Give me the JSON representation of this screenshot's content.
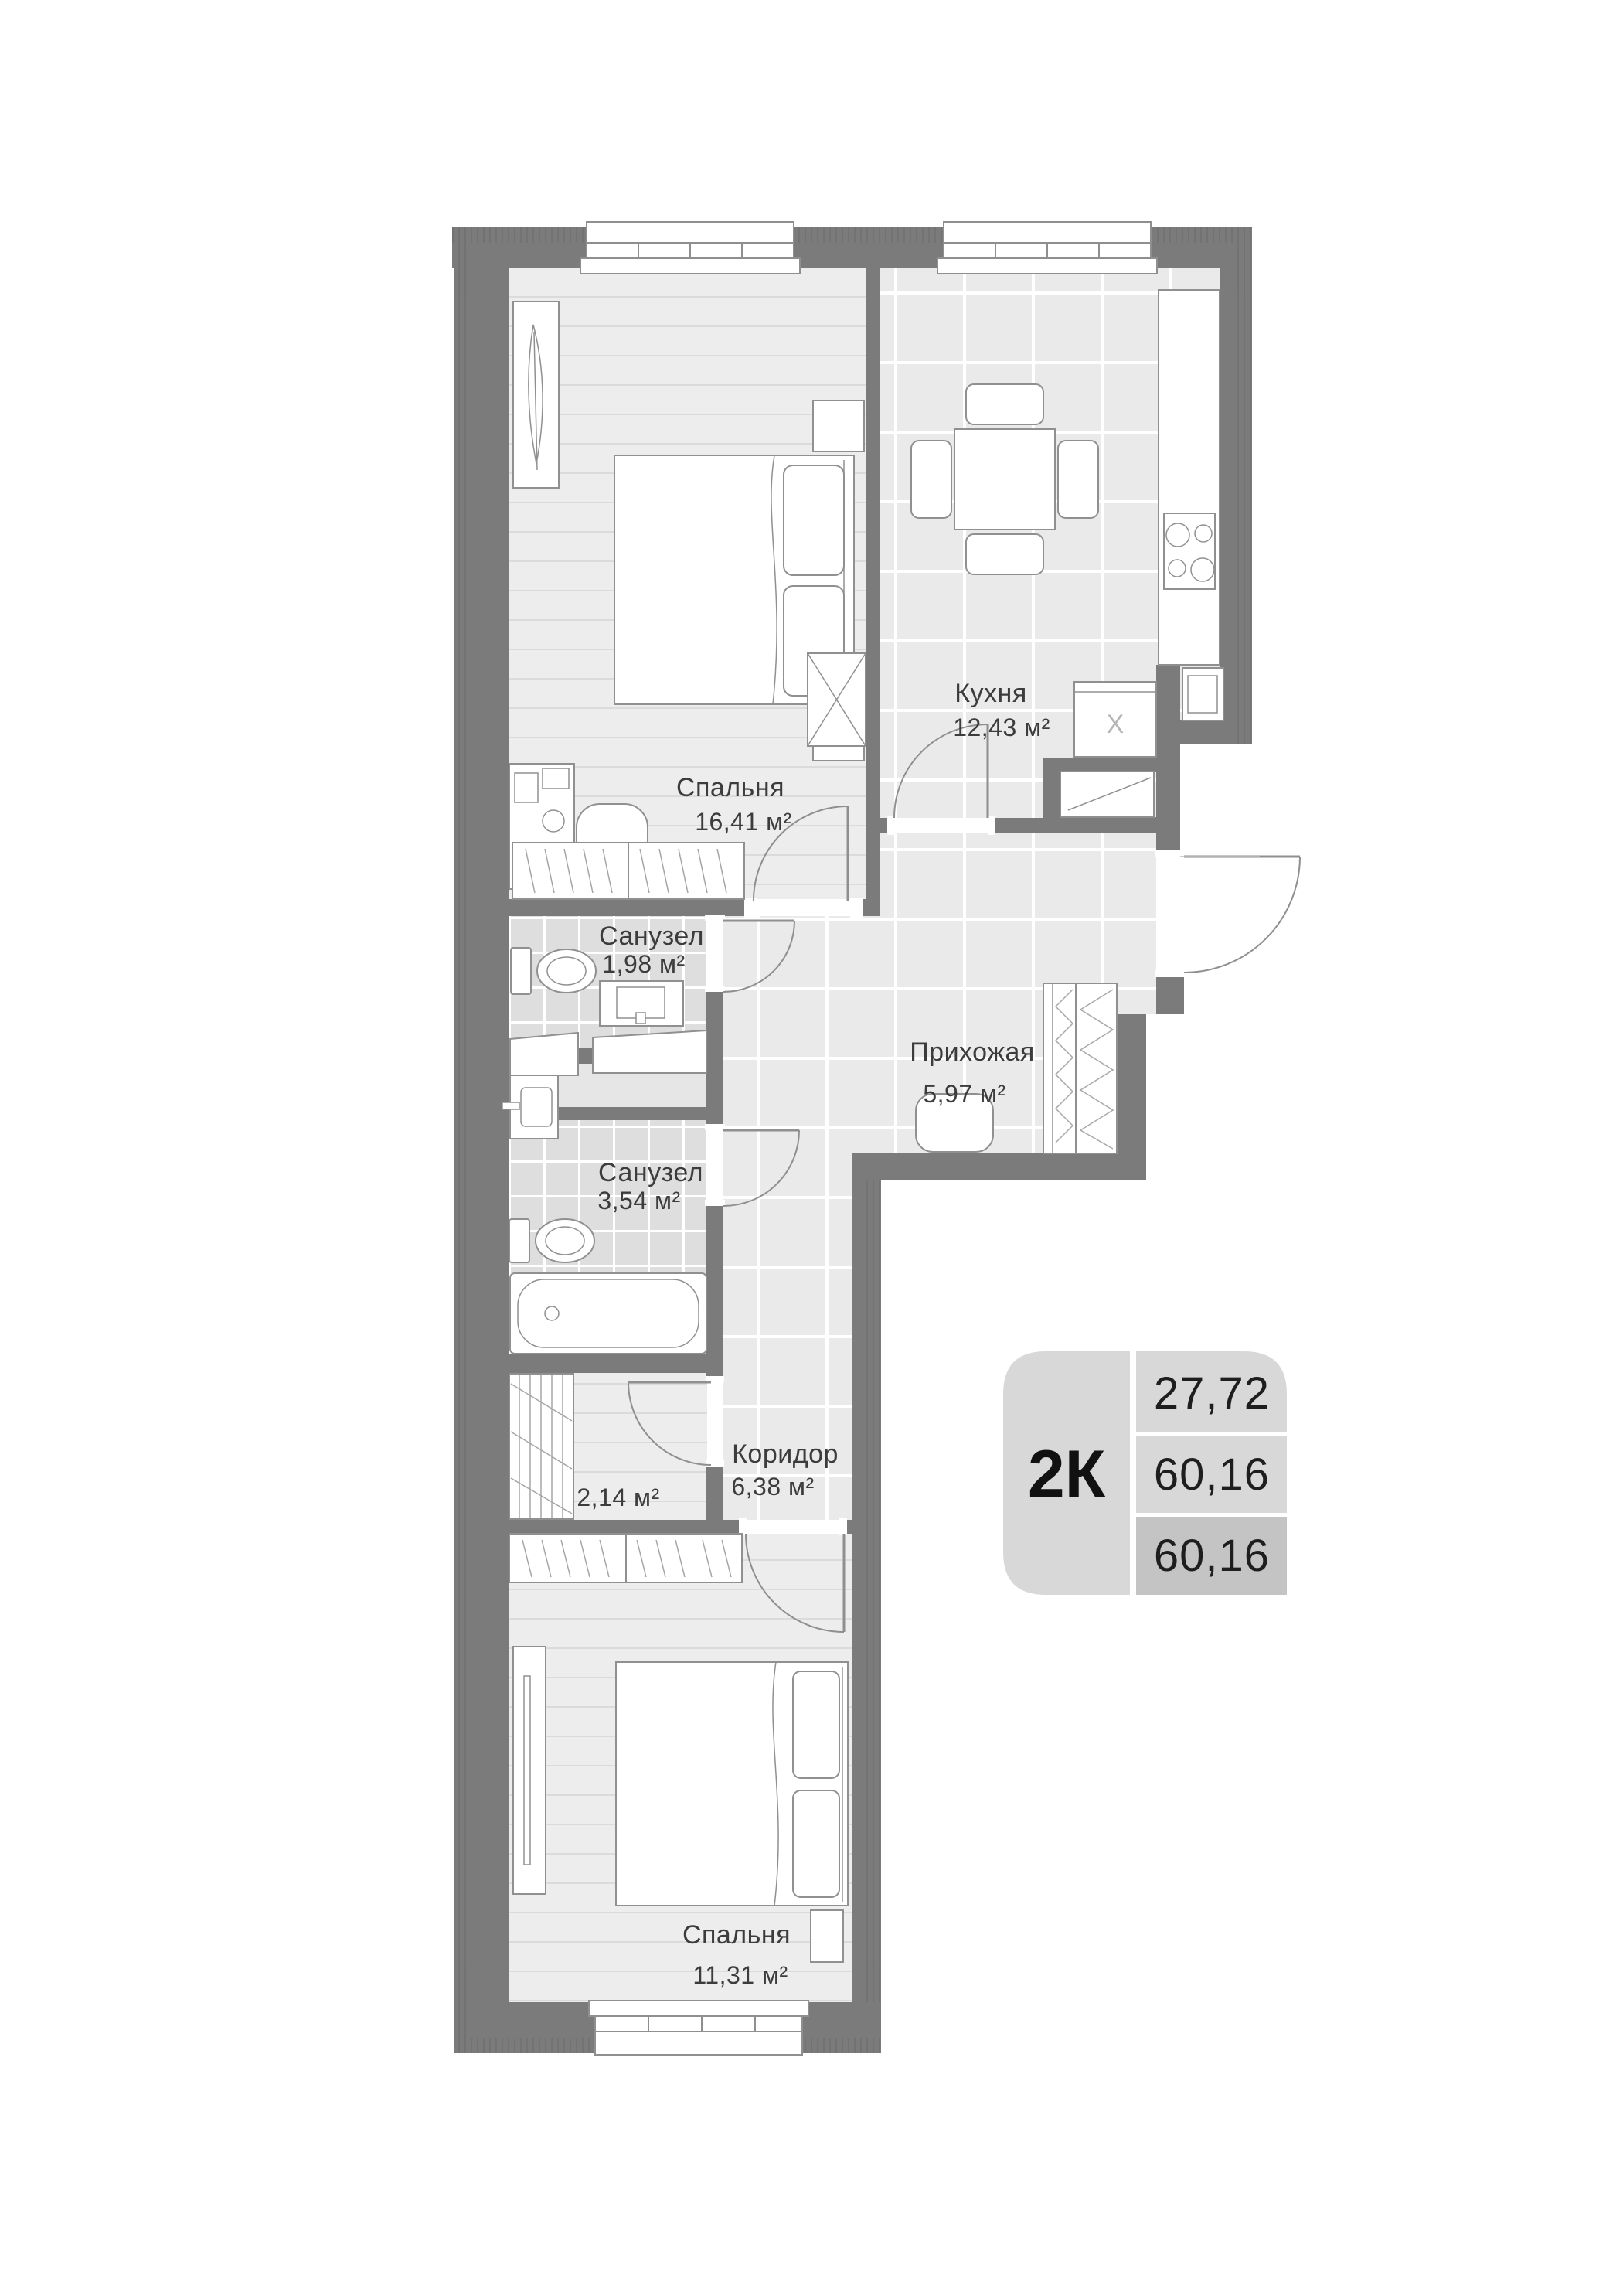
{
  "page": {
    "background": "#ffffff"
  },
  "plan": {
    "rooms": [
      {
        "key": "bedroom1",
        "name": "Спальня",
        "area": "16,41 м²"
      },
      {
        "key": "kitchen",
        "name": "Кухня",
        "area": "12,43 м²"
      },
      {
        "key": "bathroom1",
        "name": "Санузел",
        "area": "1,98 м²"
      },
      {
        "key": "hallway",
        "name": "Прихожая",
        "area": "5,97 м²"
      },
      {
        "key": "bathroom2",
        "name": "Санузел",
        "area": "3,54 м²"
      },
      {
        "key": "storage",
        "name": "",
        "area": "2,14 м²"
      },
      {
        "key": "corridor",
        "name": "Коридор",
        "area": "6,38 м²"
      },
      {
        "key": "bedroom2",
        "name": "Спальня",
        "area": "11,31 м²"
      }
    ],
    "shaft_mark": "X",
    "badge": {
      "type": "2К",
      "values": [
        "27,72",
        "60,16",
        "60,16"
      ]
    },
    "colors": {
      "wall": "#7b7b7b",
      "plank_floor": "#ededed",
      "tile_floor": "#eaeaea",
      "bath_tile": "#dedede",
      "badge_light": "#d8d8d8",
      "badge_dark": "#c4c4c4",
      "label_text": "#3c3c3c",
      "badge_text": "#1e1e1e"
    }
  }
}
